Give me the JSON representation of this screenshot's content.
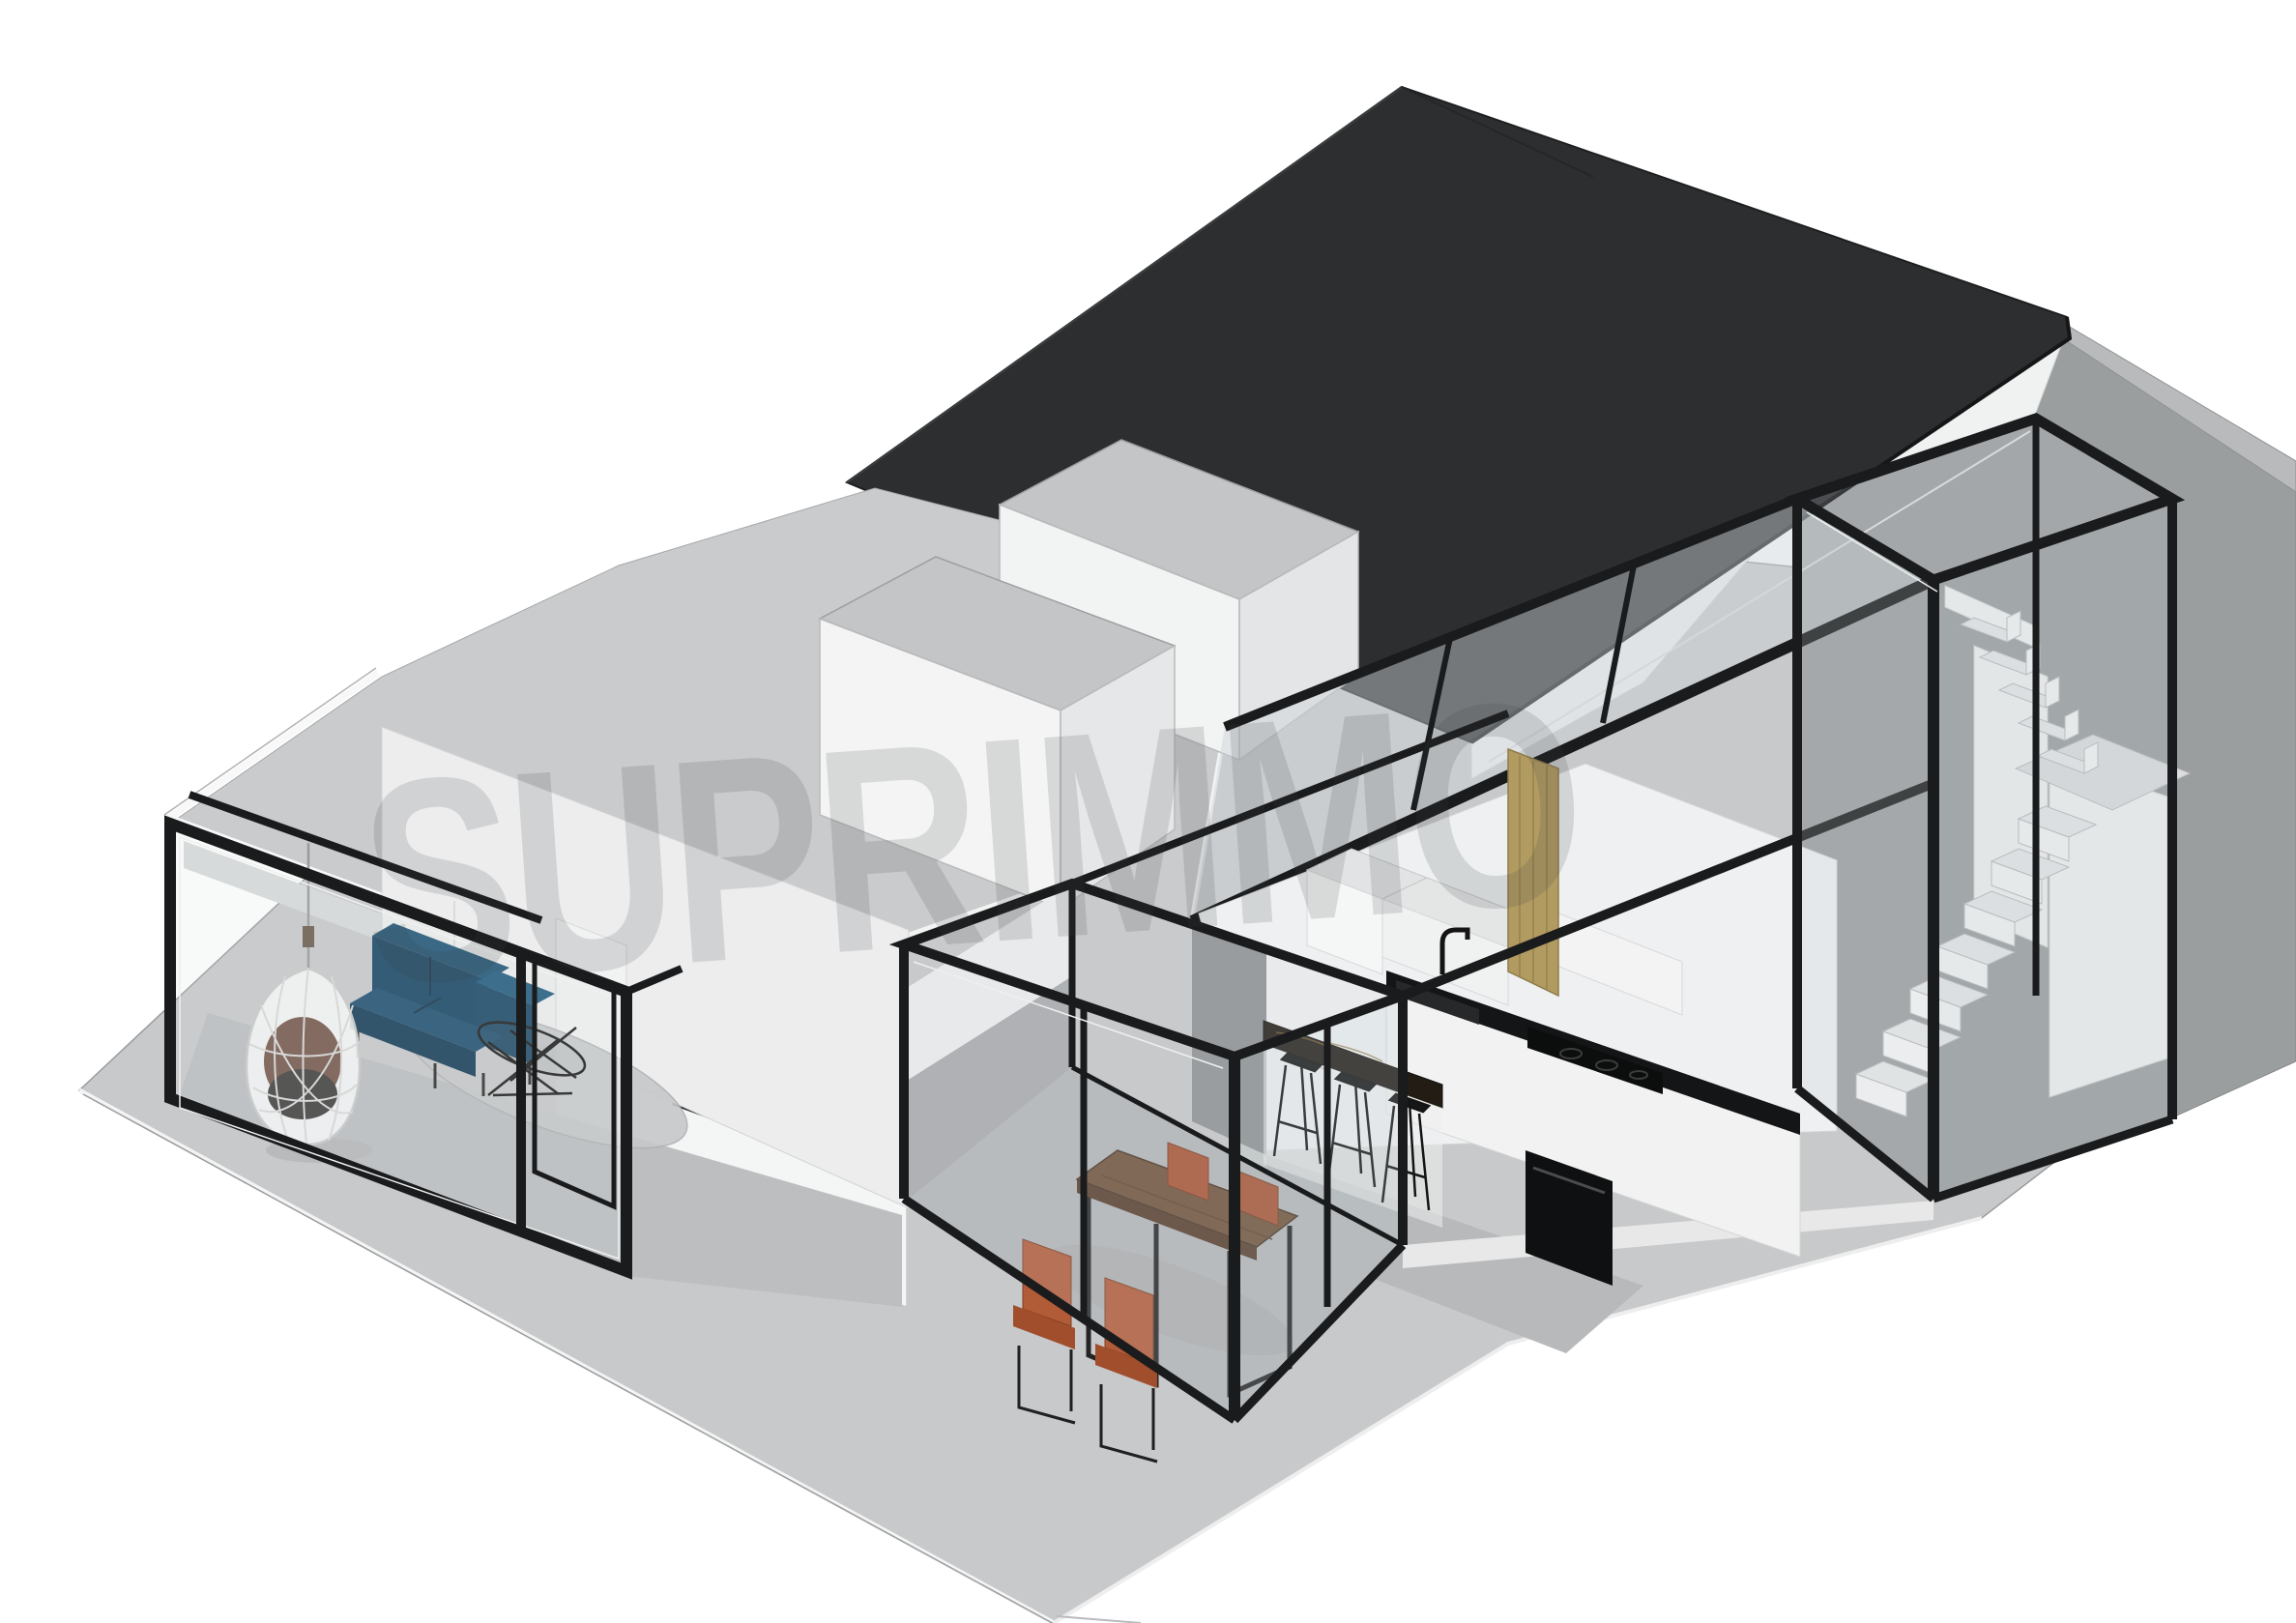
{
  "watermark": {
    "text": "SUPRIMMO"
  },
  "scene": {
    "description": "Axonometric 3D cutaway render of a single-storey apartment extension with black steel framed glass boxes, flat grey roof volumes, a dark pitched roof house and a floating staircase",
    "rooms": [
      "living-room-glass-box",
      "dining-glass-box",
      "kitchen",
      "hallway",
      "stair-glass-box"
    ],
    "furniture": [
      "blue-corner-sofa",
      "hanging-egg-chair",
      "wire-coffee-table",
      "round-rug",
      "wood-dining-table",
      "rust-dining-chairs",
      "marble-bar-counter",
      "bar-stools",
      "kitchen-counter",
      "sink-and-faucet",
      "cooktop",
      "oven",
      "floating-stairs"
    ],
    "colors": {
      "background": "#ffffff",
      "dark_roof": "#2c2e30",
      "frame_black": "#1a1b1c",
      "flat_roof_gray": "#c9cbcd",
      "ground_gray": "#c7c9ca",
      "party_wall_gray": "#9b9e9f",
      "wall_white": "#f4f5f5",
      "sofa_blue": "#1d4e6f",
      "table_wood": "#6f5138",
      "chair_rust": "#b05a36",
      "counter_black": "#141516",
      "bar_marble": "#221c15",
      "wood_panel": "#b29b61"
    }
  }
}
